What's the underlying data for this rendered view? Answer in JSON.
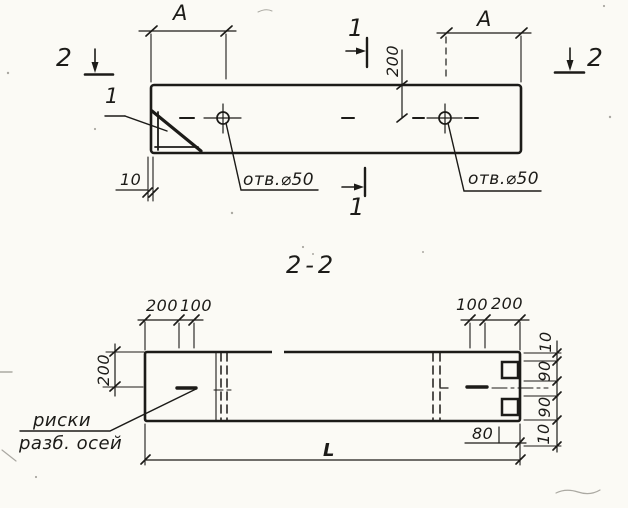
{
  "colors": {
    "paper": "#fbfaf5",
    "ink": "#1c1b18"
  },
  "top_view": {
    "dim_a_left": "А",
    "dim_a_right": "А",
    "cut2_left": "2",
    "cut2_right": "2",
    "cut1_top": "1",
    "cut1_bottom": "1",
    "dim_200": "200",
    "dim_10": "10",
    "detail_mark": "1",
    "hole_note_left": "отв.⌀50",
    "hole_note_right": "отв.⌀50"
  },
  "section_view": {
    "title": "2-2",
    "top_dims_left": [
      "200",
      "100"
    ],
    "top_dims_right": [
      "100",
      "200"
    ],
    "dim_height_200": "200",
    "right_chain": [
      "10",
      "90",
      "90",
      "10"
    ],
    "dim_80": "80",
    "dim_length": "L",
    "axes_note": [
      "риски",
      "разб. осей"
    ]
  }
}
